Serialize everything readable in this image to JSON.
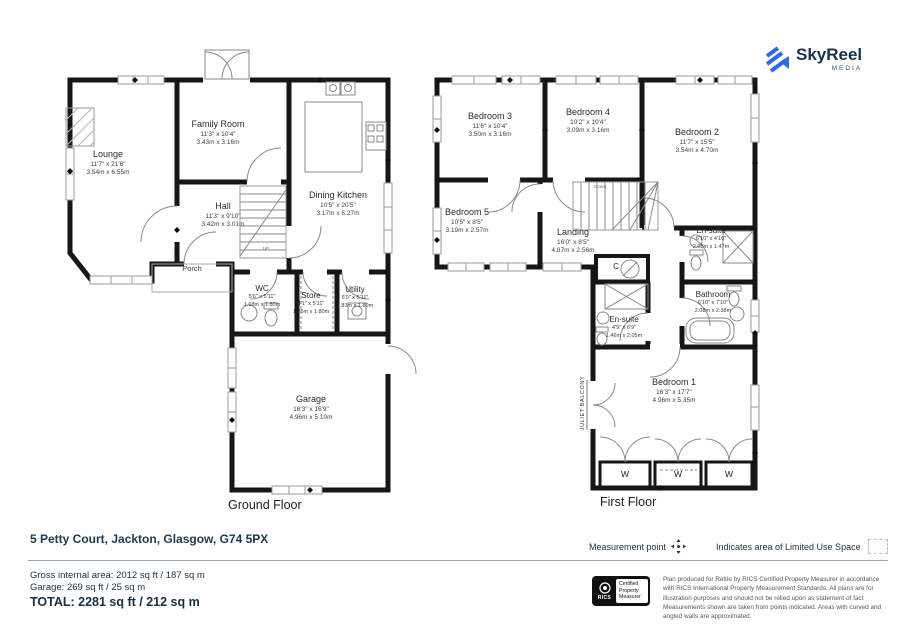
{
  "branding": {
    "name": "SkyReel",
    "sub": "MEDIA",
    "accent_color": "#3069e4",
    "text_color": "#16324a"
  },
  "ground": {
    "caption": "Ground Floor",
    "rooms": {
      "lounge": {
        "name": "Lounge",
        "ft": "11'7\" x 21'6\"",
        "m": "3.54m x 6.55m"
      },
      "family": {
        "name": "Family Room",
        "ft": "11'3\" x 10'4\"",
        "m": "3.43m x 3.16m"
      },
      "hall": {
        "name": "Hall",
        "ft": "11'3\" x 9'10\"",
        "m": "3.42m x 3.01m"
      },
      "kitchen": {
        "name": "Dining Kitchen",
        "ft": "10'5\" x 20'5\"",
        "m": "3.17m x 6.27m"
      },
      "porch": {
        "name": "Porch"
      },
      "wc": {
        "name": "WC",
        "ft": "5'6\" x 5'11\"",
        "m": "1.68m x 1.80m"
      },
      "store": {
        "name": "Store",
        "ft": "4'1\" x 5'11\"",
        "m": "1.26m x 1.80m"
      },
      "utility": {
        "name": "Utility",
        "ft": "6'0\" x 5'11\"",
        "m": "1.83m x 1.80m"
      },
      "garage": {
        "name": "Garage",
        "ft": "16'3\" x 16'9\"",
        "m": "4.96m x 5.10m"
      },
      "up": "UP"
    }
  },
  "first": {
    "caption": "First Floor",
    "rooms": {
      "bed3": {
        "name": "Bedroom 3",
        "ft": "11'6\" x 10'4\"",
        "m": "3.50m x 3.16m"
      },
      "bed4": {
        "name": "Bedroom 4",
        "ft": "10'2\" x 10'4\"",
        "m": "3.09m x 3.16m"
      },
      "bed2": {
        "name": "Bedroom 2",
        "ft": "11'7\" x 15'5\"",
        "m": "3.54m x 4.70m"
      },
      "bed5": {
        "name": "Bedroom 5",
        "ft": "10'5\" x 8'5\"",
        "m": "3.19m x 2.57m"
      },
      "landing": {
        "name": "Landing",
        "ft": "16'0\" x 8'5\"",
        "m": "4.87m x 2.56m"
      },
      "ensuite1": {
        "name": "En-suite",
        "ft": "6'10\" x 4'10\"",
        "m": "2.08m x 1.47m"
      },
      "bathroom": {
        "name": "Bathroom",
        "ft": "6'10\" x 7'10\"",
        "m": "2.08m x 2.38m"
      },
      "ensuite2": {
        "name": "En-suite",
        "ft": "4'9\" x 6'9\"",
        "m": "1.46m x 2.05m"
      },
      "bed1": {
        "name": "Bedroom 1",
        "ft": "16'3\" x 17'7\"",
        "m": "4.96m x 5.35m"
      },
      "cupboard": "C",
      "balcony": "JULIET BALCONY",
      "wardrobe": "W",
      "down": "DOWN"
    }
  },
  "footer": {
    "address": "5 Petty Court, Jackton, Glasgow, G74 5PX",
    "measurement_point": "Measurement point",
    "limited_use": "Indicates area of  Limited Use Space",
    "gross": "Gross internal area: 2012 sq ft / 187 sq m",
    "garage_area": "Garage: 269 sq ft / 25 sq m",
    "total": "TOTAL: 2281 sq ft / 212 sq m",
    "rics_label": "RICS",
    "cert1": "Certified",
    "cert2": "Property",
    "cert3": "Measurer",
    "disclaimer": "Plan produced for Rettie by RICS Certified Property Measurer in accordance with RICS International Property Measurement Standards. All plans are for illustration purposes and should not be relied upon as statement of fact Measurements shown are taken from points indicated. Areas with curved and angled walls are approximated."
  }
}
